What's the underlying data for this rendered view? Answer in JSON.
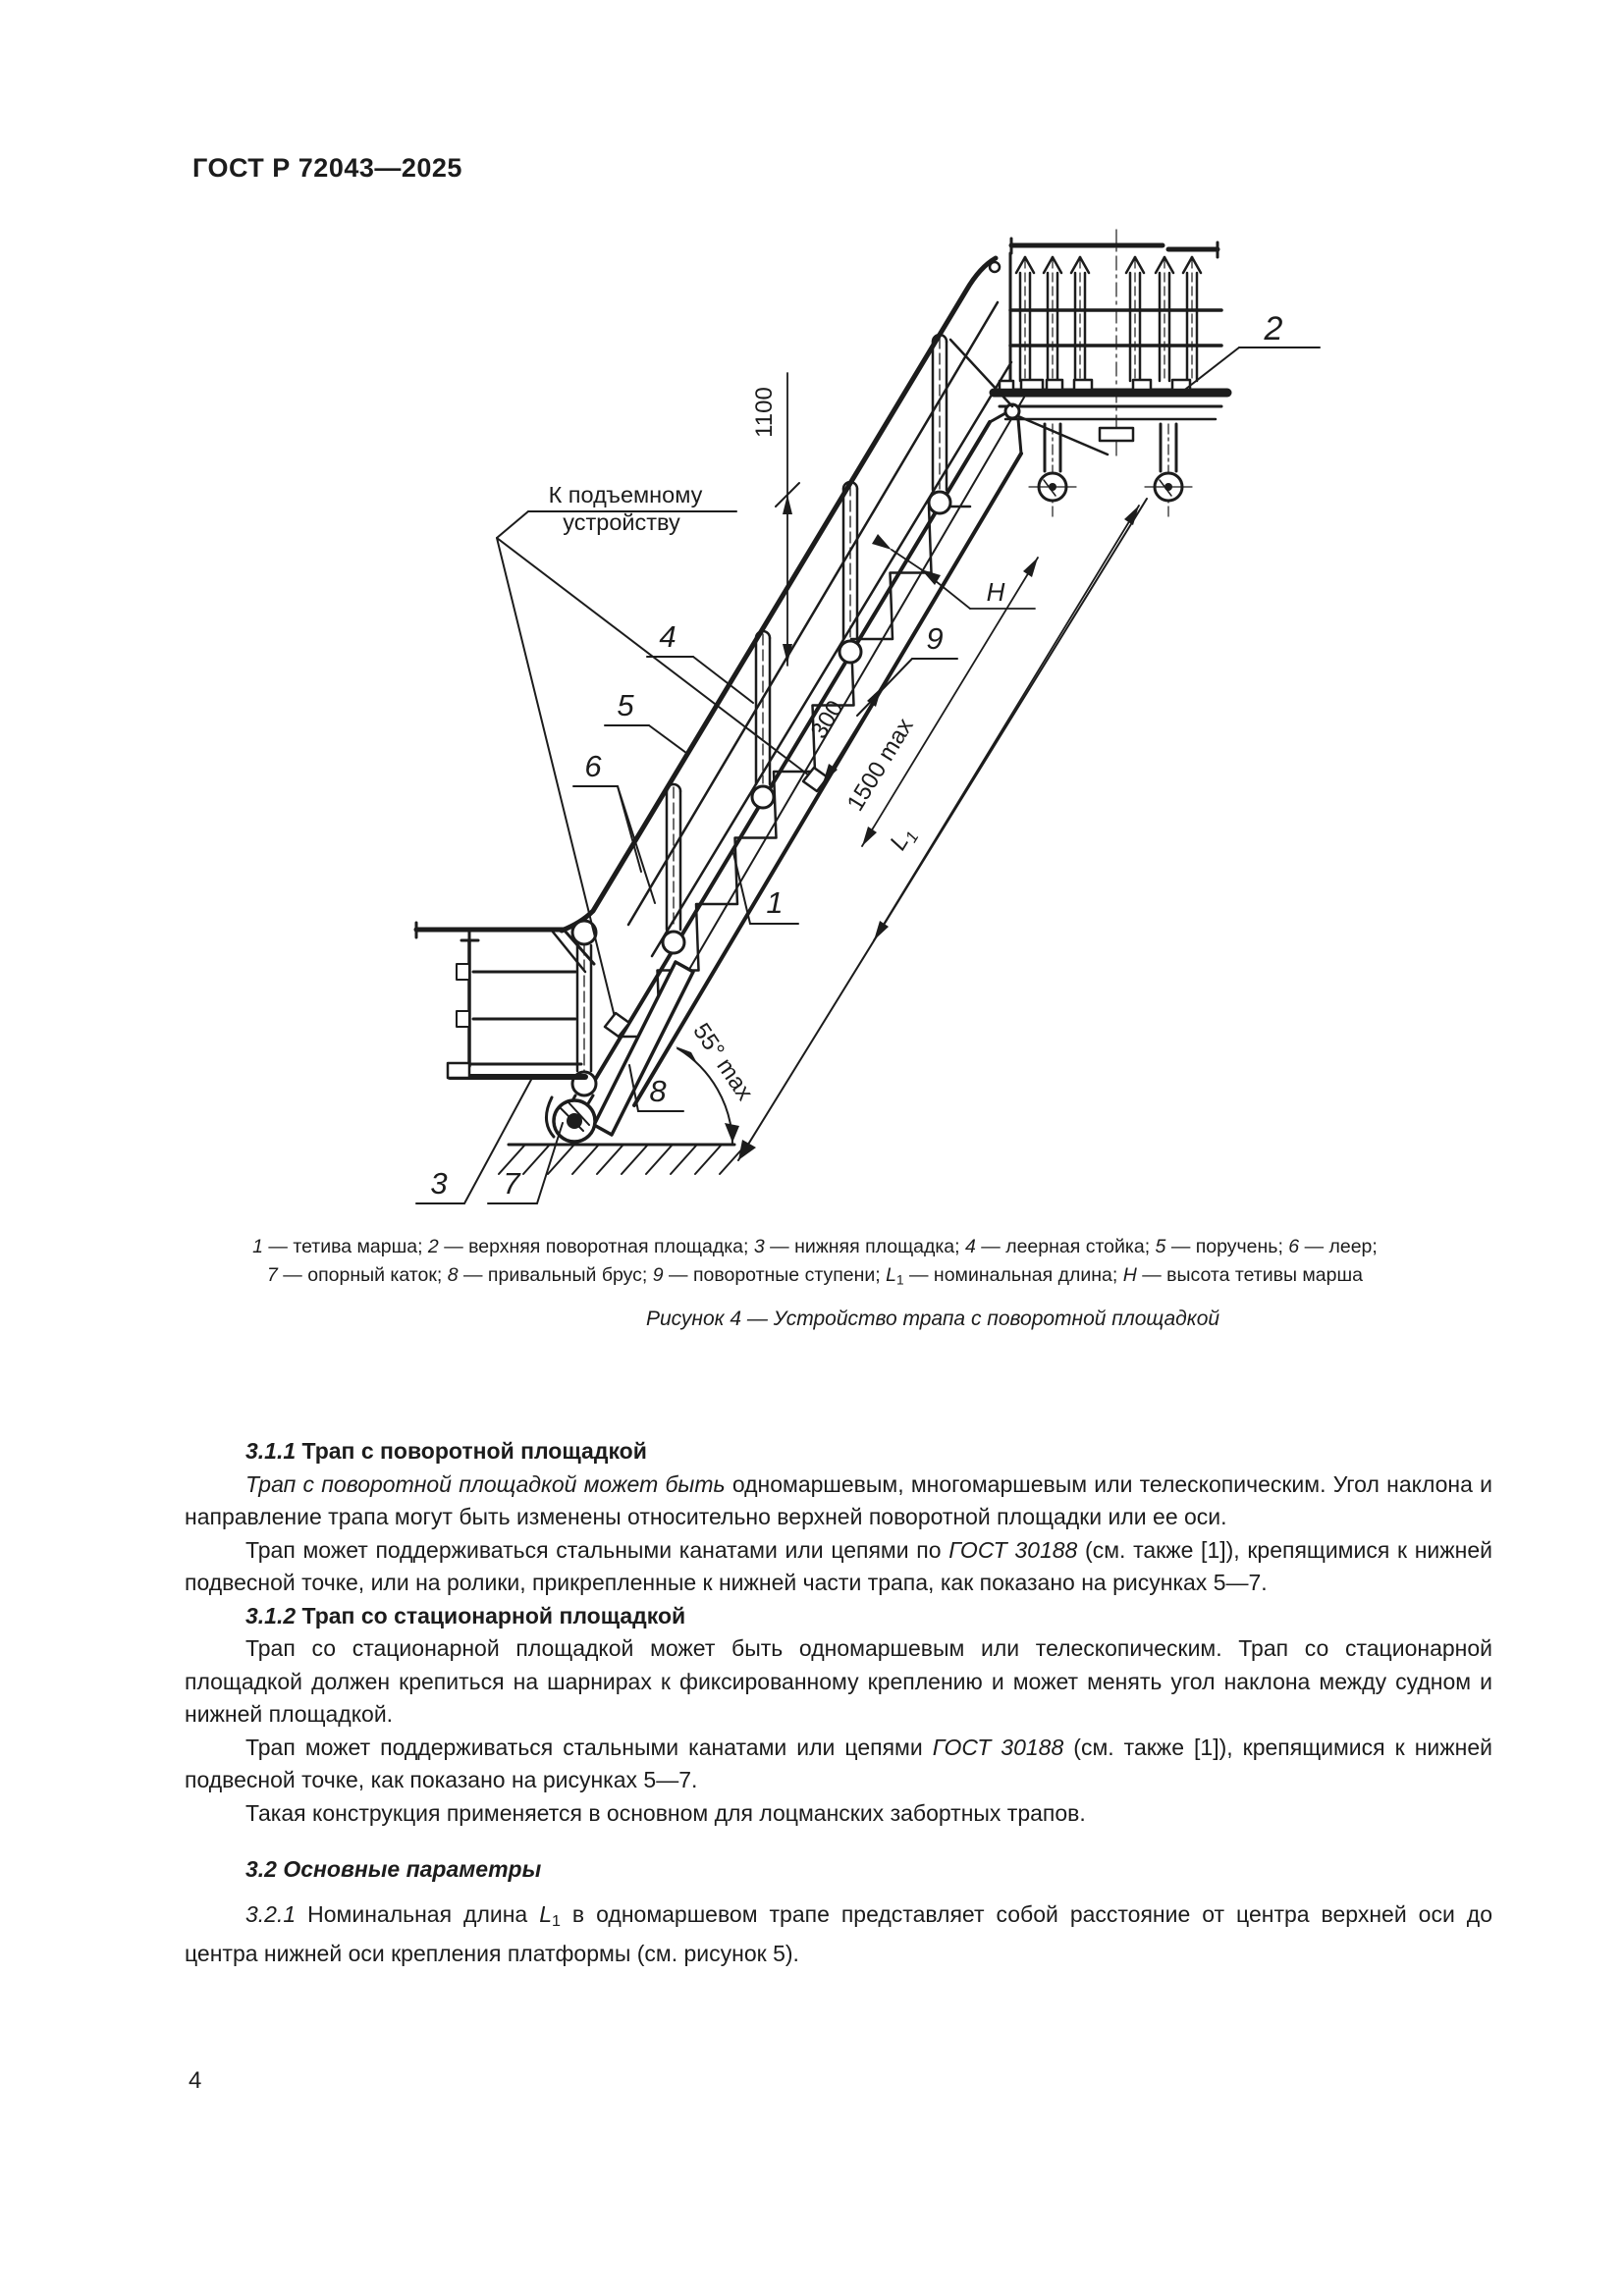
{
  "page": {
    "standard_code": "ГОСТ Р 72043—2025",
    "page_number": "4"
  },
  "figure": {
    "lift_label_line1": "К подъемному",
    "lift_label_line2": "устройству",
    "dims": {
      "d1100": "1100",
      "d300": "300",
      "d1500": "1500 max",
      "l1_main": "L",
      "l1_sub": "1",
      "h": "H",
      "angle": "55° max"
    },
    "callouts": {
      "c1": "1",
      "c2": "2",
      "c3": "3",
      "c4": "4",
      "c5": "5",
      "c6": "6",
      "c7": "7",
      "c8": "8",
      "c9": "9"
    }
  },
  "caption": {
    "line1_runs": [
      {
        "s": "i",
        "t": "1"
      },
      {
        "s": "",
        "t": " — тетива марша; "
      },
      {
        "s": "i",
        "t": "2"
      },
      {
        "s": "",
        "t": " — верхняя поворотная площадка;  "
      },
      {
        "s": "i",
        "t": "3"
      },
      {
        "s": "",
        "t": " — нижняя площадка; "
      },
      {
        "s": "i",
        "t": "4"
      },
      {
        "s": "",
        "t": " — леерная стойка; "
      },
      {
        "s": "i",
        "t": "5"
      },
      {
        "s": "",
        "t": " — поручень; "
      },
      {
        "s": "i",
        "t": "6"
      },
      {
        "s": "",
        "t": " — леер;"
      }
    ],
    "line2_runs": [
      {
        "s": "i",
        "t": "7"
      },
      {
        "s": "",
        "t": " — опорный каток; "
      },
      {
        "s": "i",
        "t": "8"
      },
      {
        "s": "",
        "t": " — привальный брус; "
      },
      {
        "s": "i",
        "t": "9"
      },
      {
        "s": "",
        "t": " — поворотные ступени; "
      },
      {
        "s": "i",
        "t": "L"
      },
      {
        "s": "sub",
        "t": "1"
      },
      {
        "s": "",
        "t": " — номинальная длина; "
      },
      {
        "s": "i",
        "t": "Н"
      },
      {
        "s": "",
        "t": " — высота тетивы марша"
      }
    ],
    "figure_title": "Рисунок 4 — Устройство трапа с поворотной площадкой"
  },
  "main": {
    "blocks": [
      {
        "runs": [
          {
            "s": "bi",
            "t": "3.1.1"
          },
          {
            "s": "b",
            "t": " Трап с поворотной площадкой"
          }
        ]
      },
      {
        "runs": [
          {
            "s": "i",
            "t": "Трап с поворотной площадкой может быть"
          },
          {
            "s": "",
            "t": " одномаршевым, многомаршевым или телескопи­ческим. Угол наклона и направление трапа могут быть изменены относительно верхней поворотной площадки или ее оси."
          }
        ]
      },
      {
        "runs": [
          {
            "s": "",
            "t": "Трап может поддерживаться стальными канатами или цепями по "
          },
          {
            "s": "i",
            "t": "ГОСТ 30188"
          },
          {
            "s": "",
            "t": " (см. также [1]), кре­пящимися к нижней подвесной точке, или на ролики, прикрепленные к нижней части трапа, как показано на рисунках 5—7."
          }
        ]
      },
      {
        "runs": [
          {
            "s": "bi",
            "t": "3.1.2"
          },
          {
            "s": "b",
            "t": " Трап со стационарной площадкой"
          }
        ]
      },
      {
        "runs": [
          {
            "s": "",
            "t": "Трап со стационарной площадкой может быть одномаршевым или телескопическим. Трап со ста­ционарной площадкой должен крепиться на шарнирах к фиксированному креплению и может менять угол наклона между судном и нижней площадкой."
          }
        ]
      },
      {
        "runs": [
          {
            "s": "",
            "t": "Трап может поддерживаться стальными канатами или цепями "
          },
          {
            "s": "i",
            "t": "ГОСТ 30188"
          },
          {
            "s": "",
            "t": " (см. также [1]), крепя­щимися к нижней подвесной точке, как показано на рисунках 5—7."
          }
        ]
      },
      {
        "runs": [
          {
            "s": "",
            "t": "Такая конструкция применяется в основном для лоцманских забортных трапов."
          }
        ]
      },
      {
        "runs": [
          {
            "s": "bi",
            "t": "3.2 Основные параметры"
          }
        ]
      },
      {
        "runs": [
          {
            "s": "i",
            "t": "3.2.1"
          },
          {
            "s": "",
            "t": " Номинальная длина "
          },
          {
            "s": "i",
            "t": "L"
          },
          {
            "s": "sub",
            "t": "1"
          },
          {
            "s": "",
            "t": " в одномаршевом трапе представляет собой расстояние от центра верхней оси до центра нижней оси крепления платформы (см. рисунок 5)."
          }
        ]
      }
    ]
  }
}
